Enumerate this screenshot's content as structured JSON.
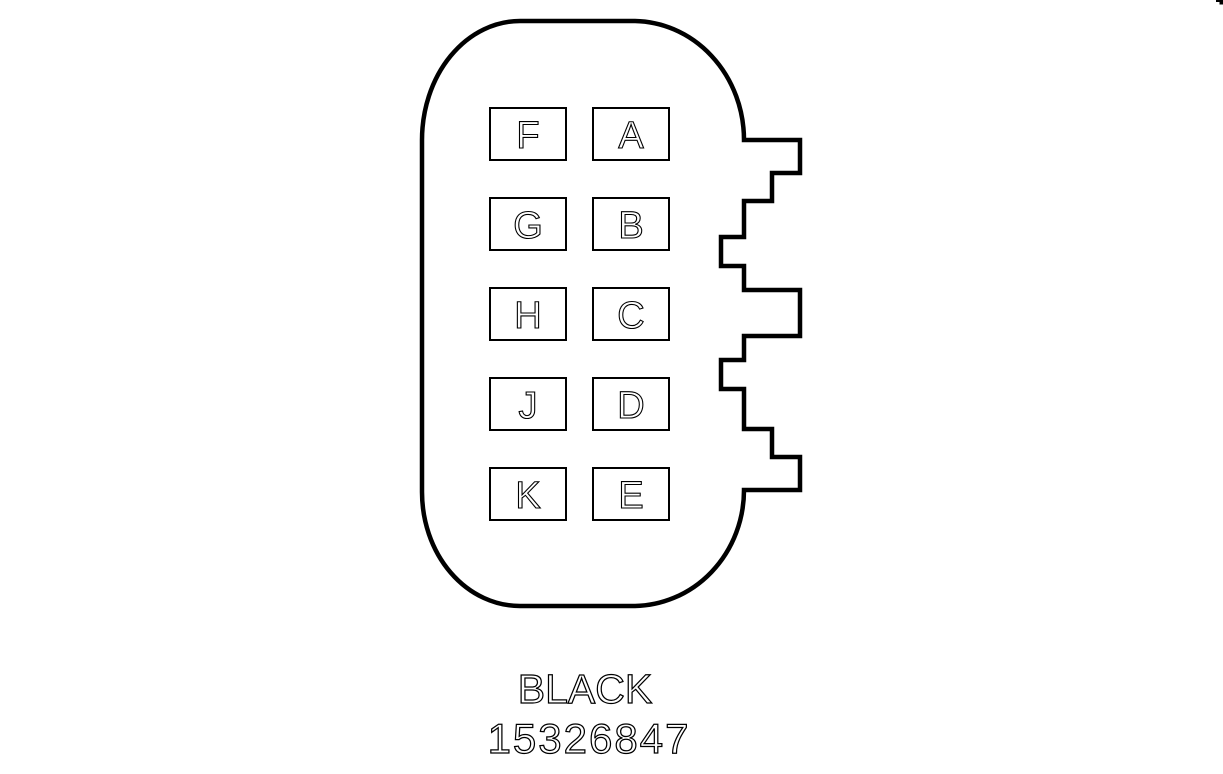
{
  "diagram": {
    "type": "connector-pinout-drawing",
    "connector": {
      "pins": {
        "left_column": [
          "F",
          "G",
          "H",
          "J",
          "K"
        ],
        "right_column": [
          "A",
          "B",
          "C",
          "D",
          "E"
        ]
      },
      "caption": {
        "color_label": "BLACK",
        "part_number": "15326847"
      }
    },
    "colors": {
      "line": "#000000",
      "background": "#ffffff"
    }
  }
}
